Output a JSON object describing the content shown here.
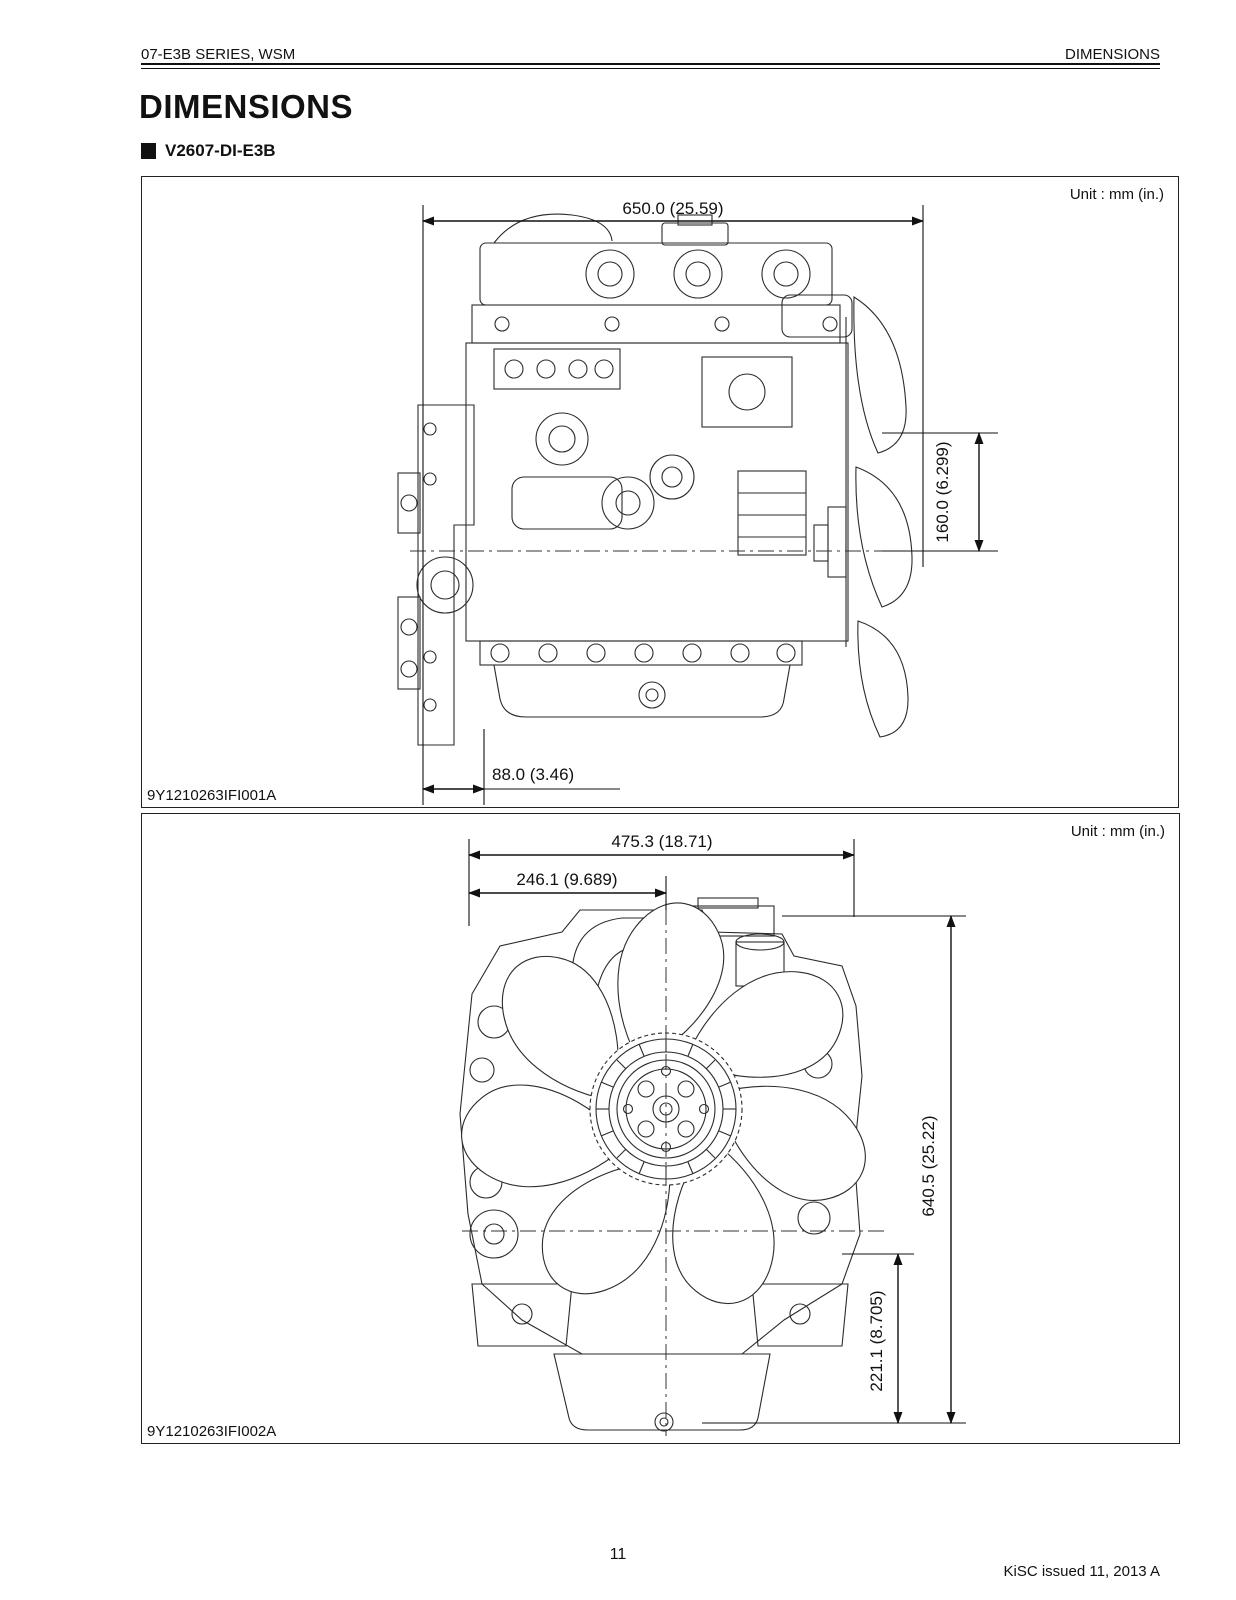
{
  "page": {
    "header_left": "07-E3B SERIES, WSM",
    "header_right": "DIMENSIONS",
    "title": "DIMENSIONS",
    "section_label": "V2607-DI-E3B",
    "page_number": "11",
    "footer_right": "KiSC issued 11, 2013 A"
  },
  "figure1": {
    "unit_label": "Unit : mm (in.)",
    "code": "9Y1210263IFI001A",
    "dims": {
      "width_total": "650.0 (25.59)",
      "height_fan_center": "160.0 (6.299)",
      "offset_front": "88.0 (3.46)"
    }
  },
  "figure2": {
    "unit_label": "Unit : mm (in.)",
    "code": "9Y1210263IFI002A",
    "dims": {
      "width_total": "475.3 (18.71)",
      "width_center": "246.1 (9.689)",
      "height_total": "640.5 (25.22)",
      "height_crank": "221.1 (8.705)"
    }
  }
}
